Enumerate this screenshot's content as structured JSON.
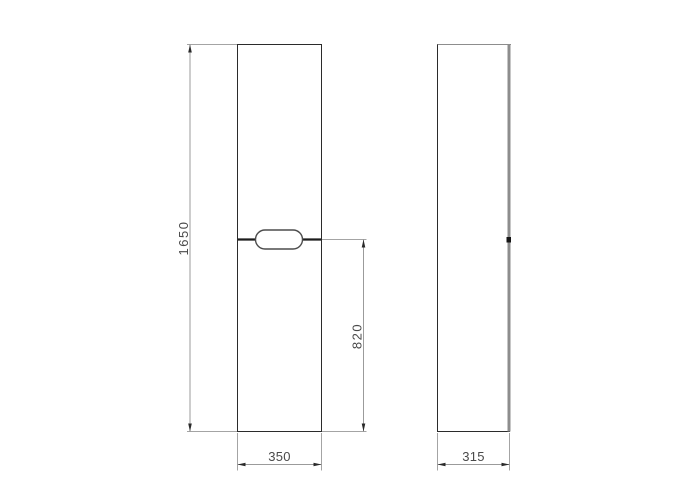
{
  "drawing": {
    "kind": "technical-dimension-drawing",
    "subject": "tall cabinet column, front and side orthographic views",
    "dimension_labels": {
      "height": "1650",
      "lower_section": "820",
      "width": "350",
      "depth": "315"
    },
    "colors": {
      "background": "#ffffff",
      "outline": "#2b2b2b",
      "divider": "#1c1c1c",
      "dimension_line": "#9b9b9b",
      "arrowhead": "#2a2a2a",
      "label_text": "#4a4a4a",
      "side_panel_edge": "#8d8d8d"
    }
  }
}
